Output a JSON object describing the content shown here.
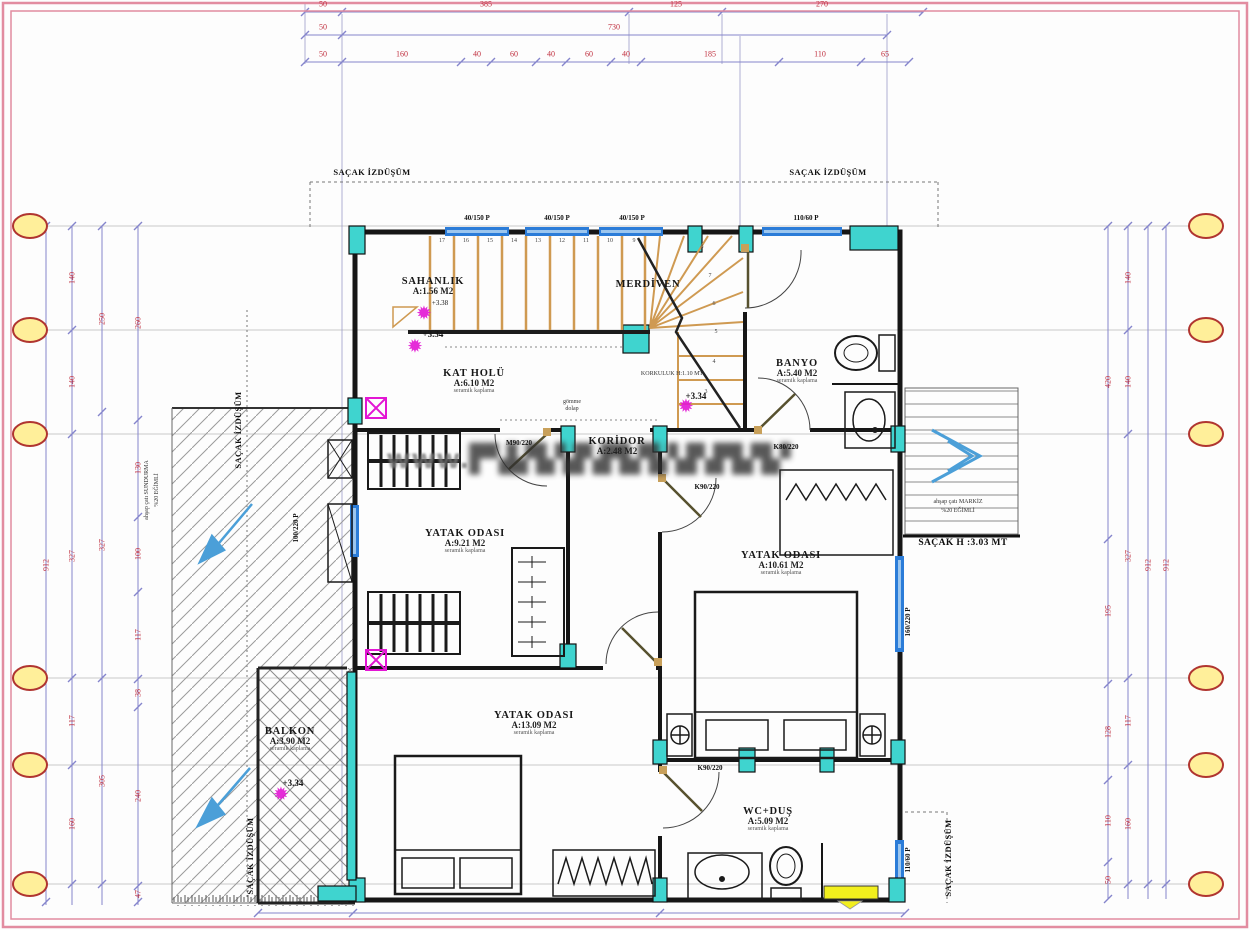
{
  "watermark": {
    "prefix": "www.",
    "obscured": "▛▚▙▜▞▟▚▛▙▜▞▟▚▛▙▜▞"
  },
  "colors": {
    "wall": "#161616",
    "column_cyan": "#3fd4cf",
    "window_blue": "#2b7cd8",
    "dim_line": "#8585cc",
    "dim_text": "#c0303f",
    "stair_tread": "#cf9a52",
    "axis_bubble_fill": "#ffef9a",
    "axis_bubble_stroke": "#b03530",
    "marker_magenta": "#e316d4",
    "frame_pink": "#e28ca0",
    "arrow_blue": "#4b9fd8",
    "highlight_yellow": "#f2ef1d"
  },
  "annotations": {
    "rooms": [
      {
        "name": "SAHANLIK",
        "area": "A:1.56 M2",
        "finish": "",
        "x": 393,
        "y": 276,
        "w": 80
      },
      {
        "name": "MERDİVEN",
        "area": "",
        "finish": "",
        "x": 598,
        "y": 279,
        "w": 100
      },
      {
        "name": "KAT HOLÜ",
        "area": "A:6.10 M2",
        "finish": "seramik kaplama",
        "x": 424,
        "y": 368,
        "w": 100
      },
      {
        "name": "BANYO",
        "area": "A:5.40 M2",
        "finish": "seramik kaplama",
        "x": 747,
        "y": 358,
        "w": 100
      },
      {
        "name": "KORİDOR",
        "area": "A:2.48 M2",
        "finish": "",
        "x": 572,
        "y": 436,
        "w": 90
      },
      {
        "name": "YATAK ODASI",
        "area": "A:9.21 M2",
        "finish": "seramik kaplama",
        "x": 410,
        "y": 528,
        "w": 110
      },
      {
        "name": "YATAK ODASI",
        "area": "A:10.61 M2",
        "finish": "seramik kaplama",
        "x": 726,
        "y": 550,
        "w": 110
      },
      {
        "name": "YATAK ODASI",
        "area": "A:13.09 M2",
        "finish": "seramik kaplama",
        "x": 479,
        "y": 710,
        "w": 110
      },
      {
        "name": "BALKON",
        "area": "A:3.90 M2",
        "finish": "seramik kaplama",
        "x": 260,
        "y": 726,
        "w": 60
      },
      {
        "name": "WC+DUŞ",
        "area": "A:5.09 M2",
        "finish": "seramik kaplama",
        "x": 728,
        "y": 806,
        "w": 80
      }
    ],
    "dims": [
      {
        "t": "50",
        "x": 323,
        "y": 4
      },
      {
        "t": "385",
        "x": 486,
        "y": 4
      },
      {
        "t": "125",
        "x": 676,
        "y": 4
      },
      {
        "t": "270",
        "x": 822,
        "y": 4
      },
      {
        "t": "50",
        "x": 323,
        "y": 27
      },
      {
        "t": "730",
        "x": 614,
        "y": 27
      },
      {
        "t": "50",
        "x": 323,
        "y": 54
      },
      {
        "t": "160",
        "x": 402,
        "y": 54
      },
      {
        "t": "40",
        "x": 477,
        "y": 54
      },
      {
        "t": "60",
        "x": 514,
        "y": 54
      },
      {
        "t": "40",
        "x": 551,
        "y": 54
      },
      {
        "t": "60",
        "x": 589,
        "y": 54
      },
      {
        "t": "40",
        "x": 626,
        "y": 54
      },
      {
        "t": "185",
        "x": 710,
        "y": 54
      },
      {
        "t": "110",
        "x": 820,
        "y": 54
      },
      {
        "t": "65",
        "x": 885,
        "y": 54
      },
      {
        "t": "912",
        "x": 46,
        "y": 565,
        "v": true
      },
      {
        "t": "140",
        "x": 72,
        "y": 278,
        "v": true
      },
      {
        "t": "140",
        "x": 72,
        "y": 382,
        "v": true
      },
      {
        "t": "327",
        "x": 72,
        "y": 556,
        "v": true
      },
      {
        "t": "117",
        "x": 72,
        "y": 721,
        "v": true
      },
      {
        "t": "160",
        "x": 72,
        "y": 824,
        "v": true
      },
      {
        "t": "250",
        "x": 102,
        "y": 319,
        "v": true
      },
      {
        "t": "327",
        "x": 102,
        "y": 545,
        "v": true
      },
      {
        "t": "305",
        "x": 102,
        "y": 781,
        "v": true
      },
      {
        "t": "260",
        "x": 138,
        "y": 323,
        "v": true
      },
      {
        "t": "130",
        "x": 138,
        "y": 468,
        "v": true
      },
      {
        "t": "100",
        "x": 138,
        "y": 554,
        "v": true
      },
      {
        "t": "117",
        "x": 138,
        "y": 635,
        "v": true
      },
      {
        "t": "38",
        "x": 138,
        "y": 693,
        "v": true
      },
      {
        "t": "240",
        "x": 138,
        "y": 796,
        "v": true
      },
      {
        "t": "47",
        "x": 138,
        "y": 894,
        "v": true
      },
      {
        "t": "420",
        "x": 1108,
        "y": 382,
        "v": true
      },
      {
        "t": "195",
        "x": 1108,
        "y": 611,
        "v": true
      },
      {
        "t": "128",
        "x": 1108,
        "y": 732,
        "v": true
      },
      {
        "t": "110",
        "x": 1108,
        "y": 821,
        "v": true
      },
      {
        "t": "50",
        "x": 1108,
        "y": 880,
        "v": true
      },
      {
        "t": "140",
        "x": 1128,
        "y": 278,
        "v": true
      },
      {
        "t": "140",
        "x": 1128,
        "y": 382,
        "v": true
      },
      {
        "t": "327",
        "x": 1128,
        "y": 556,
        "v": true
      },
      {
        "t": "117",
        "x": 1128,
        "y": 721,
        "v": true
      },
      {
        "t": "160",
        "x": 1128,
        "y": 824,
        "v": true
      },
      {
        "t": "912",
        "x": 1148,
        "y": 565,
        "v": true
      },
      {
        "t": "912",
        "x": 1166,
        "y": 565,
        "v": true
      }
    ],
    "openings": [
      {
        "t": "40/150 P",
        "x": 477,
        "y": 218
      },
      {
        "t": "40/150 P",
        "x": 557,
        "y": 218
      },
      {
        "t": "40/150 P",
        "x": 632,
        "y": 218
      },
      {
        "t": "110/60 P",
        "x": 806,
        "y": 218
      },
      {
        "t": "M90/220",
        "x": 519,
        "y": 443
      },
      {
        "t": "K80/220",
        "x": 786,
        "y": 447
      },
      {
        "t": "K90/220",
        "x": 707,
        "y": 487
      },
      {
        "t": "K90/220",
        "x": 710,
        "y": 768
      },
      {
        "t": "100/220 P",
        "x": 296,
        "y": 528,
        "v": true
      },
      {
        "t": "160/220 P",
        "x": 908,
        "y": 622,
        "v": true
      },
      {
        "t": "110/60 P",
        "x": 908,
        "y": 860,
        "v": true
      }
    ],
    "eaves": [
      {
        "t": "SAÇAK İZDÜŞÜM",
        "x": 372,
        "y": 172
      },
      {
        "t": "SAÇAK İZDÜŞÜM",
        "x": 828,
        "y": 172
      },
      {
        "t": "SAÇAK İZDÜŞÜM",
        "x": 238,
        "y": 430,
        "v": true
      },
      {
        "t": "SAÇAK İZDÜŞÜM",
        "x": 250,
        "y": 856,
        "v": true
      },
      {
        "t": "SAÇAK İZDÜŞÜM",
        "x": 948,
        "y": 858,
        "v": true
      }
    ],
    "notes": [
      {
        "t": "ahşap çatı SUNDURMA",
        "x": 147,
        "y": 490,
        "v": true
      },
      {
        "t": "%20 EĞİMLİ",
        "x": 157,
        "y": 490,
        "v": true
      },
      {
        "t": "ahşap çatı MARKİZ",
        "x": 958,
        "y": 502
      },
      {
        "t": "%20 EĞİMLİ",
        "x": 958,
        "y": 511
      },
      {
        "t": "SAÇAK H :3.03 MT",
        "x": 963,
        "y": 543,
        "big": true
      },
      {
        "t": "KORKULUK H:1.10 MT",
        "x": 672,
        "y": 374
      },
      {
        "t": "gömme",
        "x": 572,
        "y": 402
      },
      {
        "t": "dolap",
        "x": 572,
        "y": 409
      }
    ],
    "elevations": [
      {
        "t": "+3.38",
        "x": 440,
        "y": 303,
        "s": true
      },
      {
        "t": "+3.34",
        "x": 433,
        "y": 334
      },
      {
        "t": "+3.34",
        "x": 696,
        "y": 396
      },
      {
        "t": "+3.34",
        "x": 293,
        "y": 783
      }
    ],
    "stars": [
      {
        "x": 424,
        "y": 314
      },
      {
        "x": 415,
        "y": 347
      },
      {
        "x": 686,
        "y": 407
      },
      {
        "x": 281,
        "y": 795
      }
    ],
    "stair_numbers": [
      {
        "t": "17",
        "x": 442,
        "y": 241
      },
      {
        "t": "16",
        "x": 466,
        "y": 241
      },
      {
        "t": "15",
        "x": 490,
        "y": 241
      },
      {
        "t": "14",
        "x": 514,
        "y": 241
      },
      {
        "t": "13",
        "x": 538,
        "y": 241
      },
      {
        "t": "12",
        "x": 562,
        "y": 241
      },
      {
        "t": "11",
        "x": 586,
        "y": 241
      },
      {
        "t": "10",
        "x": 610,
        "y": 241
      },
      {
        "t": "9",
        "x": 634,
        "y": 241
      },
      {
        "t": "8",
        "x": 702,
        "y": 247
      },
      {
        "t": "7",
        "x": 710,
        "y": 276
      },
      {
        "t": "6",
        "x": 714,
        "y": 304
      },
      {
        "t": "5",
        "x": 716,
        "y": 332
      },
      {
        "t": "4",
        "x": 714,
        "y": 362
      },
      {
        "t": "3",
        "x": 706,
        "y": 392
      }
    ]
  }
}
